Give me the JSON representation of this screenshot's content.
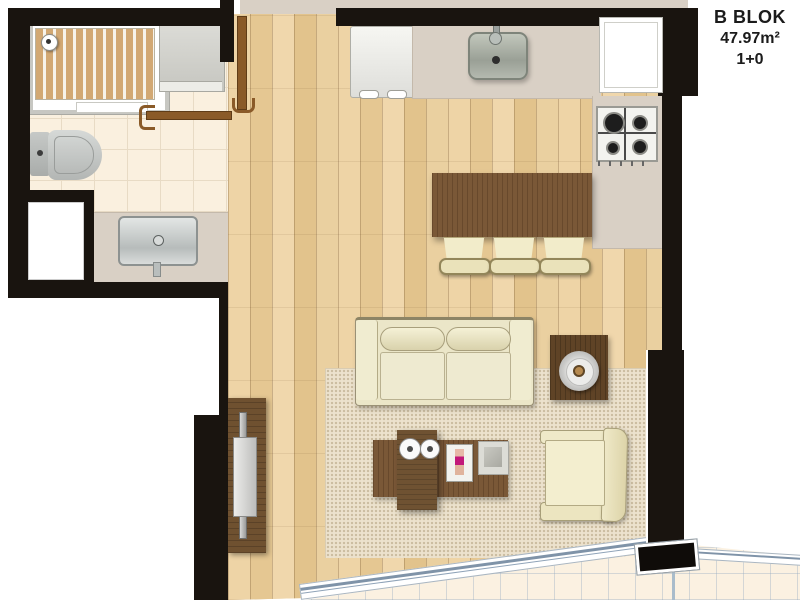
{
  "header": {
    "block_label": "B BLOK",
    "area_label": "47.97m²",
    "plan_type_label": "1+0"
  },
  "colors": {
    "wall": "#19140f",
    "wood_floor": "#ead0a0",
    "counter": "#d9d0c5",
    "bathroom_tile": "#faf0df",
    "balcony_tile": "#fbf1e1",
    "balcony_grid": "#8fa3b8",
    "dark_wood_furniture": "#7a5837",
    "rug": "#ece2cd",
    "upholstery": "#efe9cb",
    "glass_wall_line": "#7f93a8"
  },
  "legend": {
    "rooms": [
      "bathroom",
      "kitchen",
      "living-area",
      "balcony"
    ],
    "fixtures": [
      "shower",
      "washer-cabinet",
      "toilet",
      "vanity-sink",
      "fridge",
      "kitchen-sink",
      "cooktop",
      "bar-counter",
      "bar-stool",
      "sofa",
      "rug",
      "coffee-table",
      "side-table-lamp",
      "armchair",
      "tv-unit",
      "entry-door",
      "bathroom-door",
      "window",
      "glass-balcony-wall"
    ]
  }
}
